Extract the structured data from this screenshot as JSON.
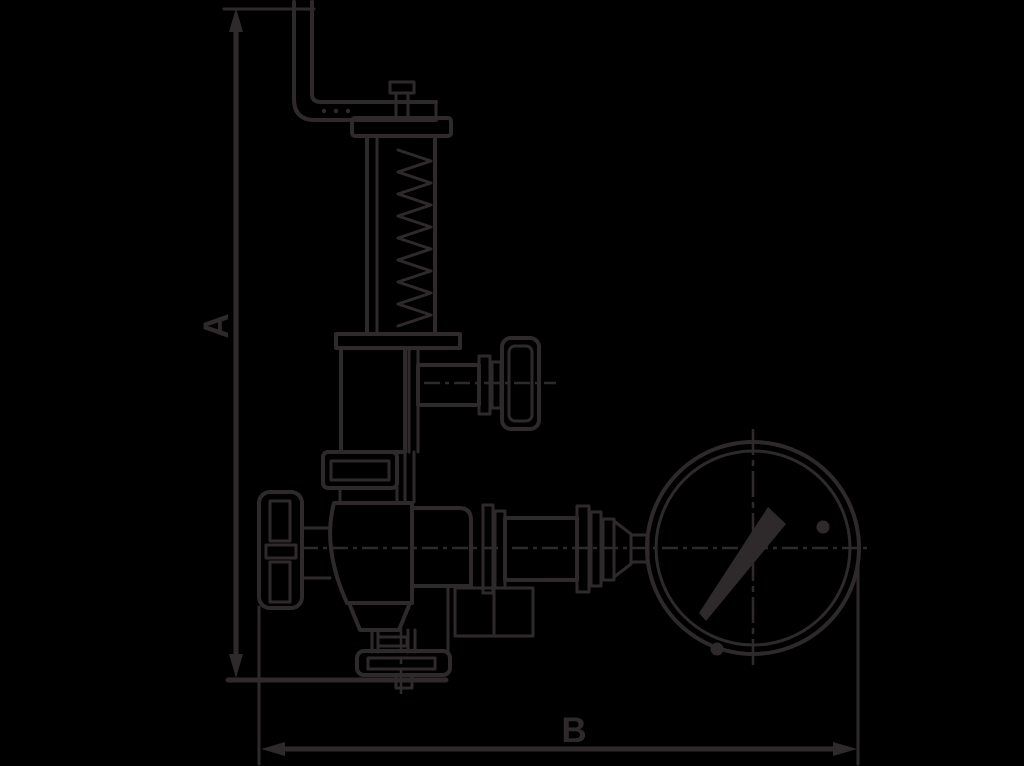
{
  "diagram": {
    "labels": {
      "dimension_vertical": "A",
      "dimension_horizontal": "B"
    },
    "colors": {
      "background": "#000000",
      "ink": "#2e2a2b"
    }
  }
}
